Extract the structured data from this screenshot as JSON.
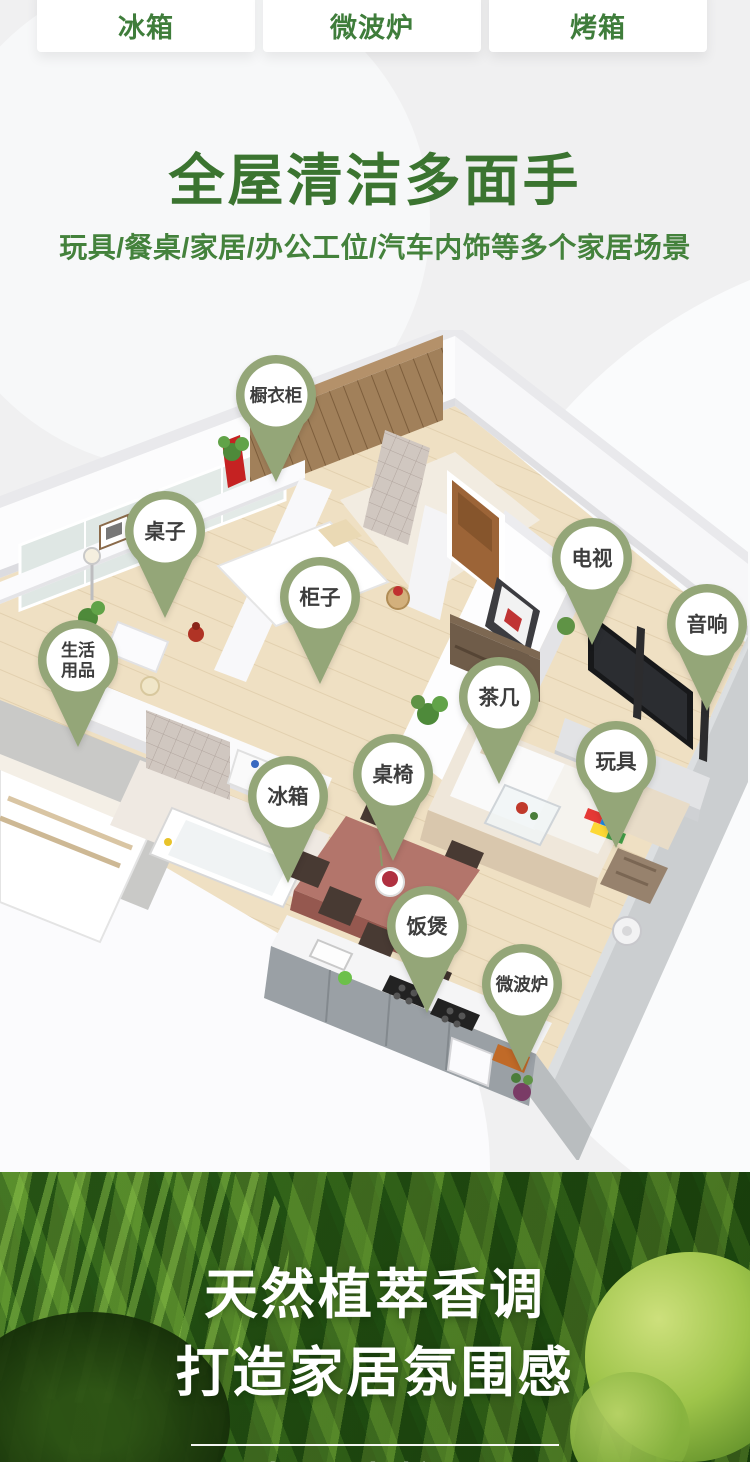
{
  "tabs": [
    {
      "label": "冰箱"
    },
    {
      "label": "微波炉"
    },
    {
      "label": "烤箱"
    }
  ],
  "hero": {
    "title": "全屋清洁多面手",
    "subtitle": "玩具/餐桌/家居/办公工位/汽车内饰等多个家居场景"
  },
  "floorplan": {
    "pins": [
      {
        "id": "wardrobe",
        "label": "橱衣柜",
        "lines": [
          "橱衣柜"
        ],
        "x": 276,
        "y": 395
      },
      {
        "id": "desk",
        "label": "桌子",
        "lines": [
          "桌子"
        ],
        "x": 165,
        "y": 531
      },
      {
        "id": "cabinet",
        "label": "柜子",
        "lines": [
          "柜子"
        ],
        "x": 320,
        "y": 597
      },
      {
        "id": "tv",
        "label": "电视",
        "lines": [
          "电视"
        ],
        "x": 592,
        "y": 558
      },
      {
        "id": "speaker",
        "label": "音响",
        "lines": [
          "音响"
        ],
        "x": 707,
        "y": 624
      },
      {
        "id": "daily-necessities",
        "label": "生活用品",
        "lines": [
          "生活",
          "用品"
        ],
        "x": 78,
        "y": 660
      },
      {
        "id": "tea-table",
        "label": "茶几",
        "lines": [
          "茶几"
        ],
        "x": 499,
        "y": 697
      },
      {
        "id": "toys",
        "label": "玩具",
        "lines": [
          "玩具"
        ],
        "x": 616,
        "y": 761
      },
      {
        "id": "fridge",
        "label": "冰箱",
        "lines": [
          "冰箱"
        ],
        "x": 288,
        "y": 796
      },
      {
        "id": "dining-set",
        "label": "桌椅",
        "lines": [
          "桌椅"
        ],
        "x": 393,
        "y": 774
      },
      {
        "id": "rice-cooker",
        "label": "饭煲",
        "lines": [
          "饭煲"
        ],
        "x": 427,
        "y": 926
      },
      {
        "id": "microwave",
        "label": "微波炉",
        "lines": [
          "微波炉"
        ],
        "x": 522,
        "y": 984
      }
    ]
  },
  "banner": {
    "headline1": "天然植萃香调",
    "headline2": "打造家居氛围感",
    "tagline": "椰风青柠香"
  },
  "colors": {
    "accent_green": "#3b7430",
    "tab_green": "#3f7d3b",
    "pin_green": "#94a678",
    "pin_text": "#3d3d3d",
    "banner_green": "#2c5715"
  }
}
